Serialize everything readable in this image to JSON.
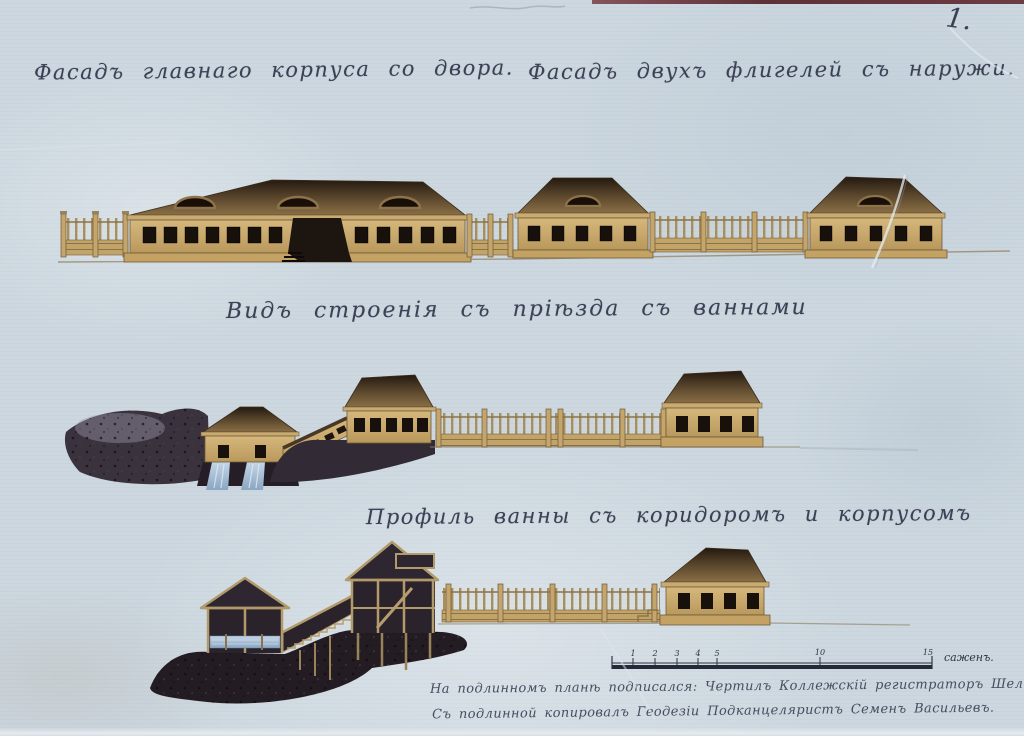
{
  "sheet": {
    "number": "1.",
    "paper_color": "#ccd7df",
    "ink_color": "#3b4054"
  },
  "captions": {
    "main_facade": "Фасадъ главнаго корпуса со двора.",
    "wings_facade": "Фасадъ двухъ флигелей съ наружи.",
    "bath_view": "Видъ строенія съ пріѣзда съ ваннами",
    "bath_profile": "Профиль ванны съ коридоромъ и корпусомъ"
  },
  "scale_bar": {
    "ticks": [
      "1",
      "2",
      "3",
      "4",
      "5",
      "10",
      "15"
    ],
    "unit_label": "саженъ."
  },
  "inscriptions": {
    "line1": "На подлинномъ планѣ подписался: Чертилъ Коллежскій регистраторъ Шелковниковъ",
    "line2": "Съ подлинной копировалъ Геодезіи Подканцеляристъ Семенъ Васильевъ."
  }
}
